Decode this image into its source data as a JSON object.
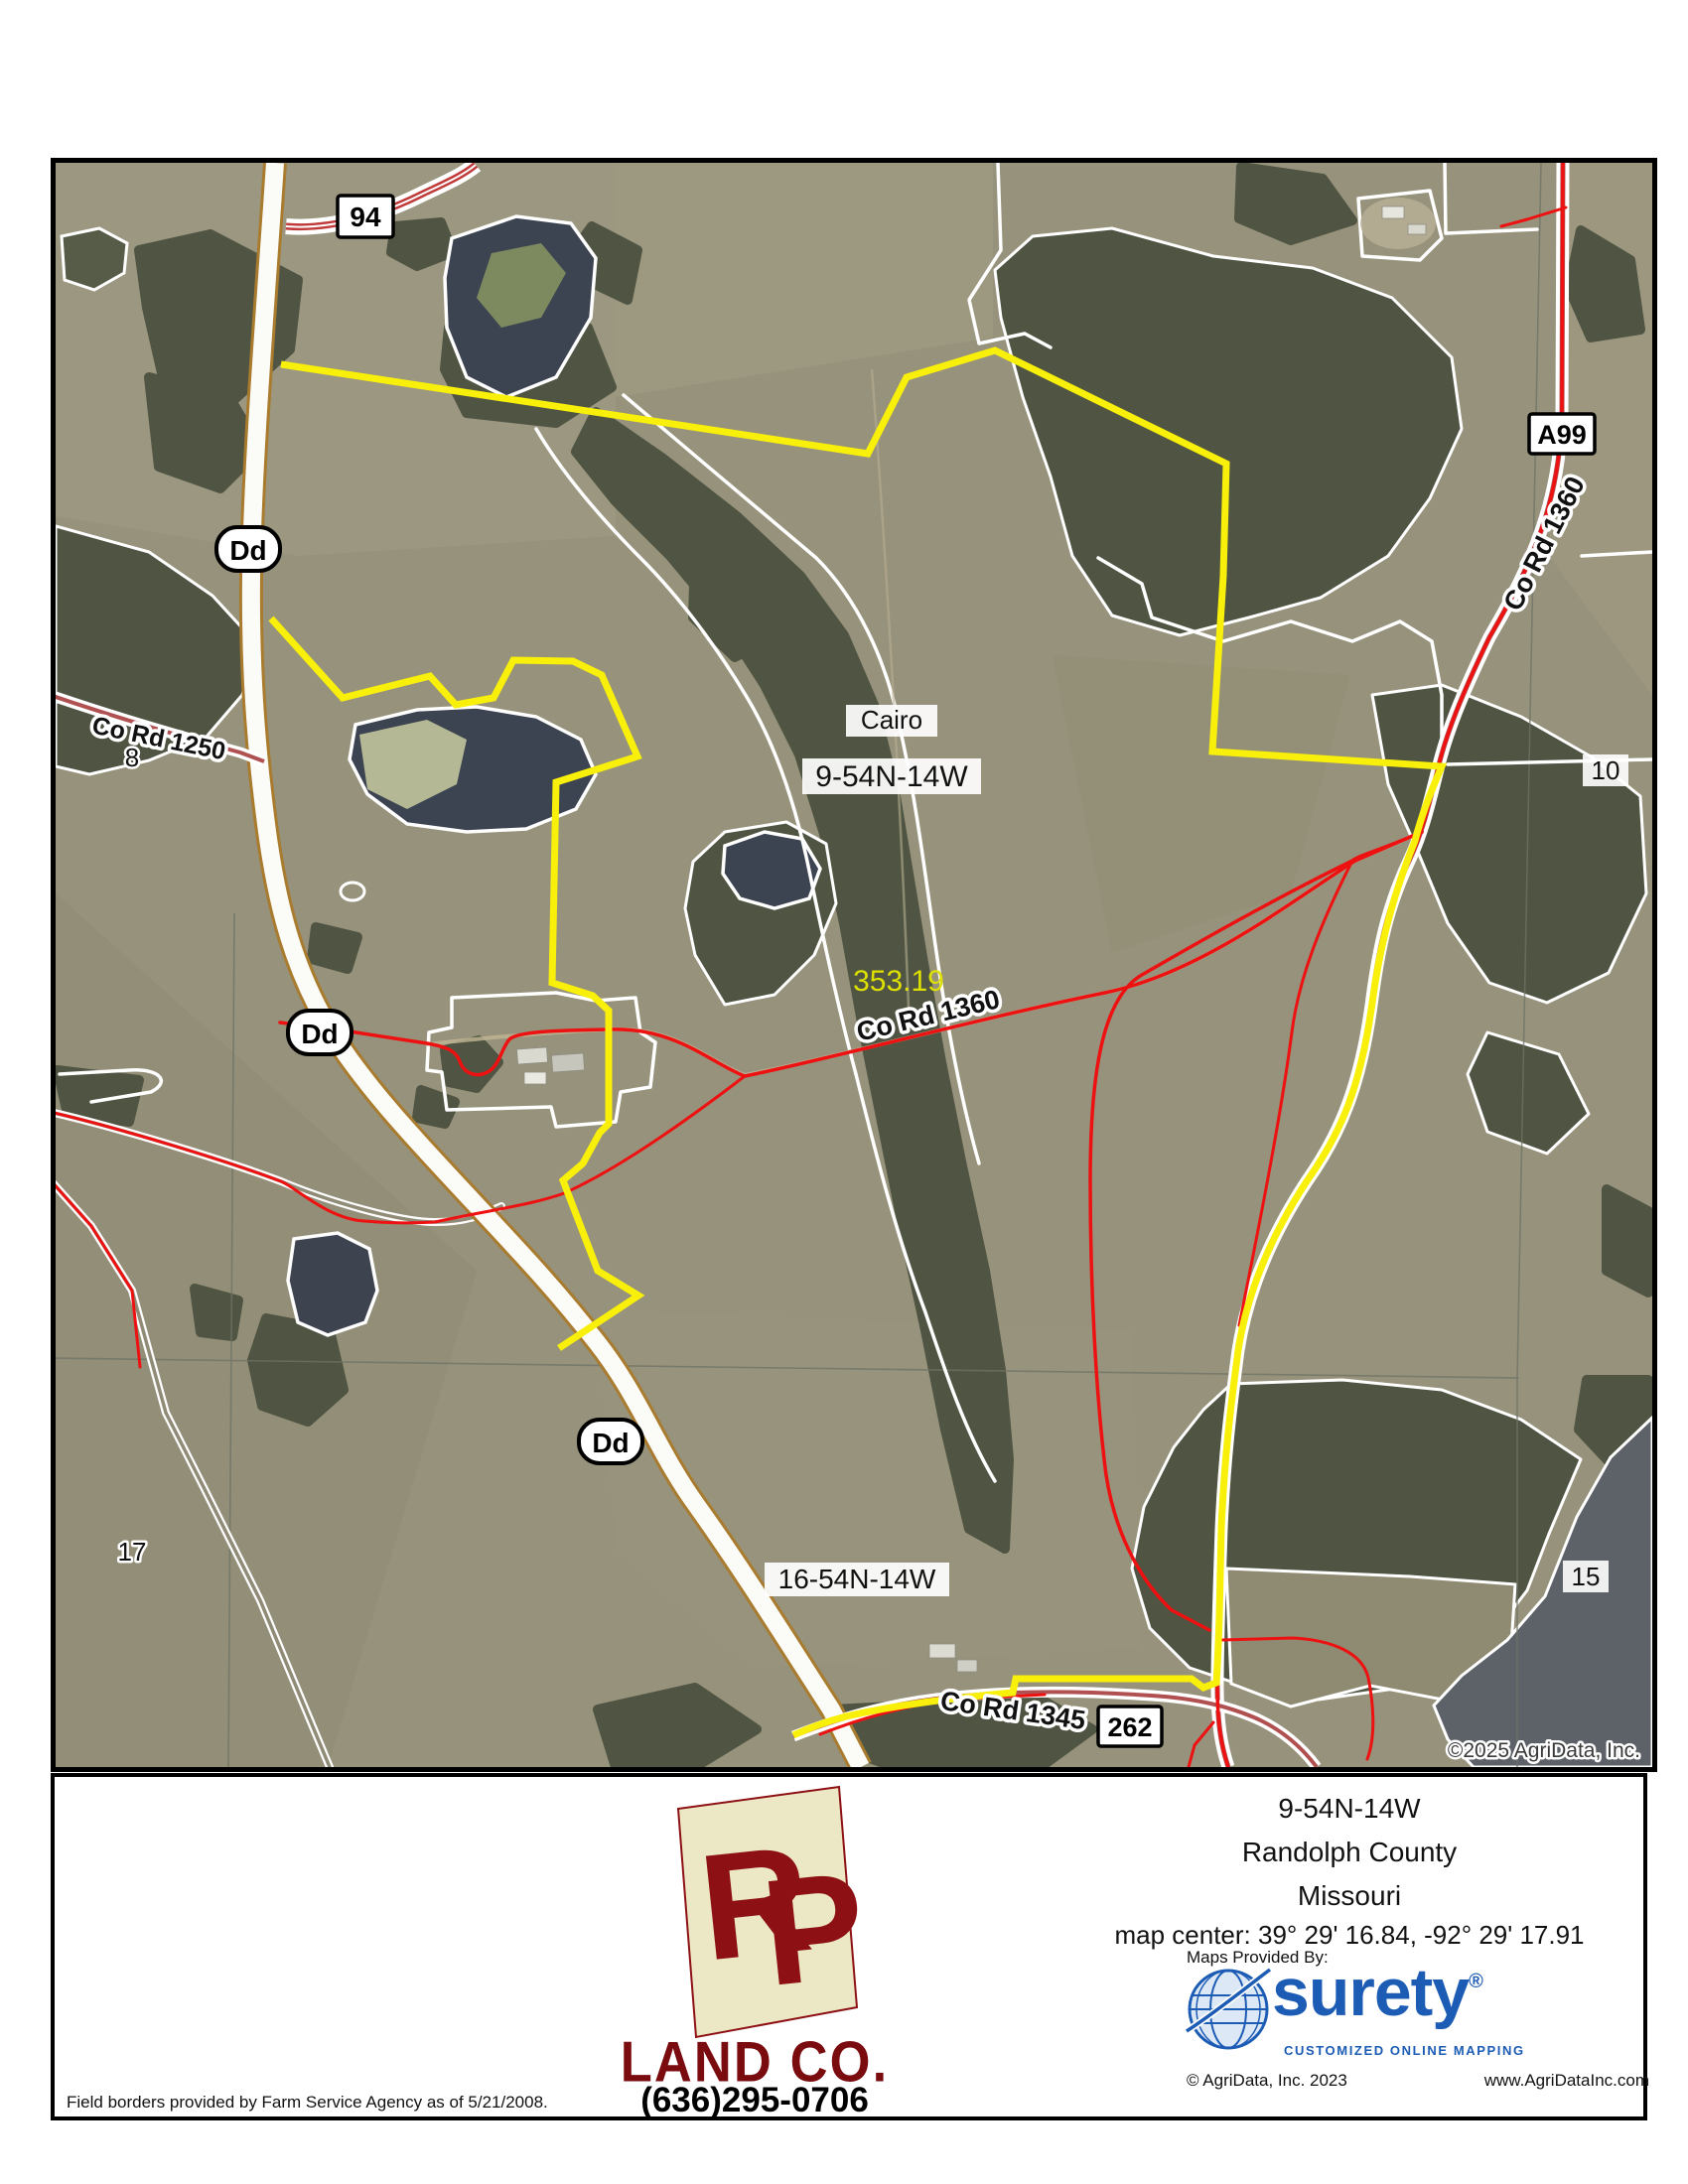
{
  "map": {
    "copyright": "©2025 AgriData, Inc.",
    "labels": {
      "place": "Cairo",
      "township_9": "9-54N-14W",
      "township_16": "16-54N-14W",
      "acreage": "353.19",
      "section_8": "8",
      "section_10": "10",
      "section_15": "15",
      "section_17": "17"
    },
    "roads": {
      "co_rd_1250": "Co Rd 1250",
      "co_rd_1360_mid": "Co Rd 1360",
      "co_rd_1360_ne": "Co Rd 1360",
      "co_rd_1345": "Co Rd 1345"
    },
    "shields": {
      "route_94": "94",
      "route_a99": "A99",
      "route_262": "262",
      "route_dd": "Dd"
    }
  },
  "footer": {
    "company": {
      "monogram_r": "R",
      "monogram_p": "P",
      "name": "LAND CO.",
      "phone": "(636)295-0706"
    },
    "location": {
      "township": "9-54N-14W",
      "county": "Randolph County",
      "state": "Missouri",
      "map_center": "map center: 39° 29' 16.84,  -92° 29' 17.91"
    },
    "provider": {
      "label": "Maps Provided By:",
      "brand": "surety",
      "registered": "®",
      "tagline": "CUSTOMIZED ONLINE MAPPING",
      "copyright": "© AgriData, Inc. 2023",
      "website": "www.AgriDataInc.com"
    },
    "disclaimer": "Field borders provided by Farm Service Agency as of 5/21/2008."
  },
  "colors": {
    "parcel_boundary": "#f8ef0a",
    "gps_track": "#ee1111",
    "brand_red": "#7a0c10",
    "surety_blue": "#1d5cb5"
  }
}
